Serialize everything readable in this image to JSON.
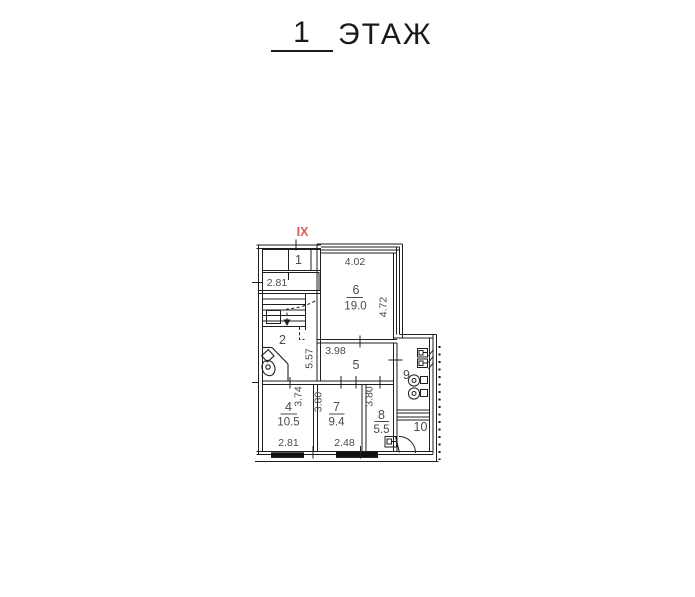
{
  "title": {
    "floor_number": "1",
    "floor_word": "ЭТАЖ"
  },
  "axis_label": "IX",
  "colors": {
    "line": "#1f1f1f",
    "text": "#4a4a4a",
    "axis_red": "#d95b5b"
  },
  "rooms": {
    "r1": {
      "number": "1"
    },
    "r2": {
      "number": "2"
    },
    "r4": {
      "number": "4",
      "area": "10.5"
    },
    "r5": {
      "number": "5"
    },
    "r6": {
      "number": "6",
      "area": "19.0"
    },
    "r7": {
      "number": "7",
      "area": "9.4"
    },
    "r8": {
      "number": "8",
      "area": "5.5"
    },
    "r9": {
      "number": "9"
    },
    "r10": {
      "number": "10"
    }
  },
  "dimensions": {
    "room1_width": "2.81",
    "room2_height": "5.57",
    "room6_width": "4.02",
    "room6_height": "4.72",
    "room5_width": "3.98",
    "room4_height": "3.74",
    "room4_width": "2.81",
    "room7_height": "3.80",
    "room7_width": "2.48",
    "room8_height": "3.80"
  }
}
